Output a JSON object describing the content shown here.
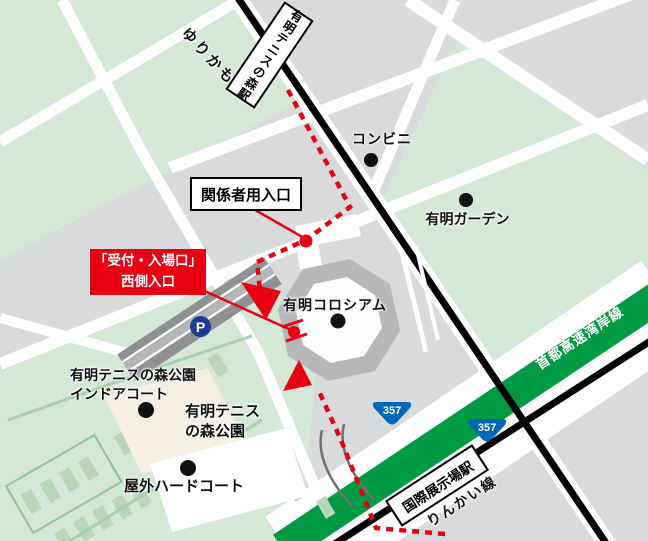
{
  "map_title": "有明コロシアム 周辺案内図",
  "labels": {
    "yurikamome_line": "ゆりかもめ",
    "station_top": "有明テニスの森駅",
    "convenience_store": "コンビニ",
    "staff_entrance": "関係者用入口",
    "ariake_garden": "有明ガーデン",
    "reception_line1": "「受付・入場口」",
    "reception_line2": "西側入口",
    "coliseum": "有明コロシアム",
    "parking": "P",
    "indoor_court_line1": "有明テニスの森公園",
    "indoor_court_line2": "インドアコート",
    "park_line1": "有明テニス",
    "park_line2": "の森公園",
    "outdoor_court": "屋外ハードコート",
    "expressway": "首都高速湾岸線",
    "route_shield_1": "357",
    "route_shield_2": "357",
    "station_bottom": "国際展示場駅",
    "rinkai_line": "りんかい線"
  },
  "colors": {
    "background_gray": "#d9dadb",
    "park_green": "#d5e7d6",
    "court_green": "#b9d5ba",
    "street_white": "#ffffff",
    "rail_black": "#000000",
    "expressway_green": "#009944",
    "route_red": "#e60012",
    "shield_blue": "#0068b7",
    "parking_blue": "#1c3b96",
    "coliseum_ring_gray": "#b6b7b8",
    "indoor_building_cream": "#f5efe4",
    "parking_strip_gray": "#8f9193"
  }
}
